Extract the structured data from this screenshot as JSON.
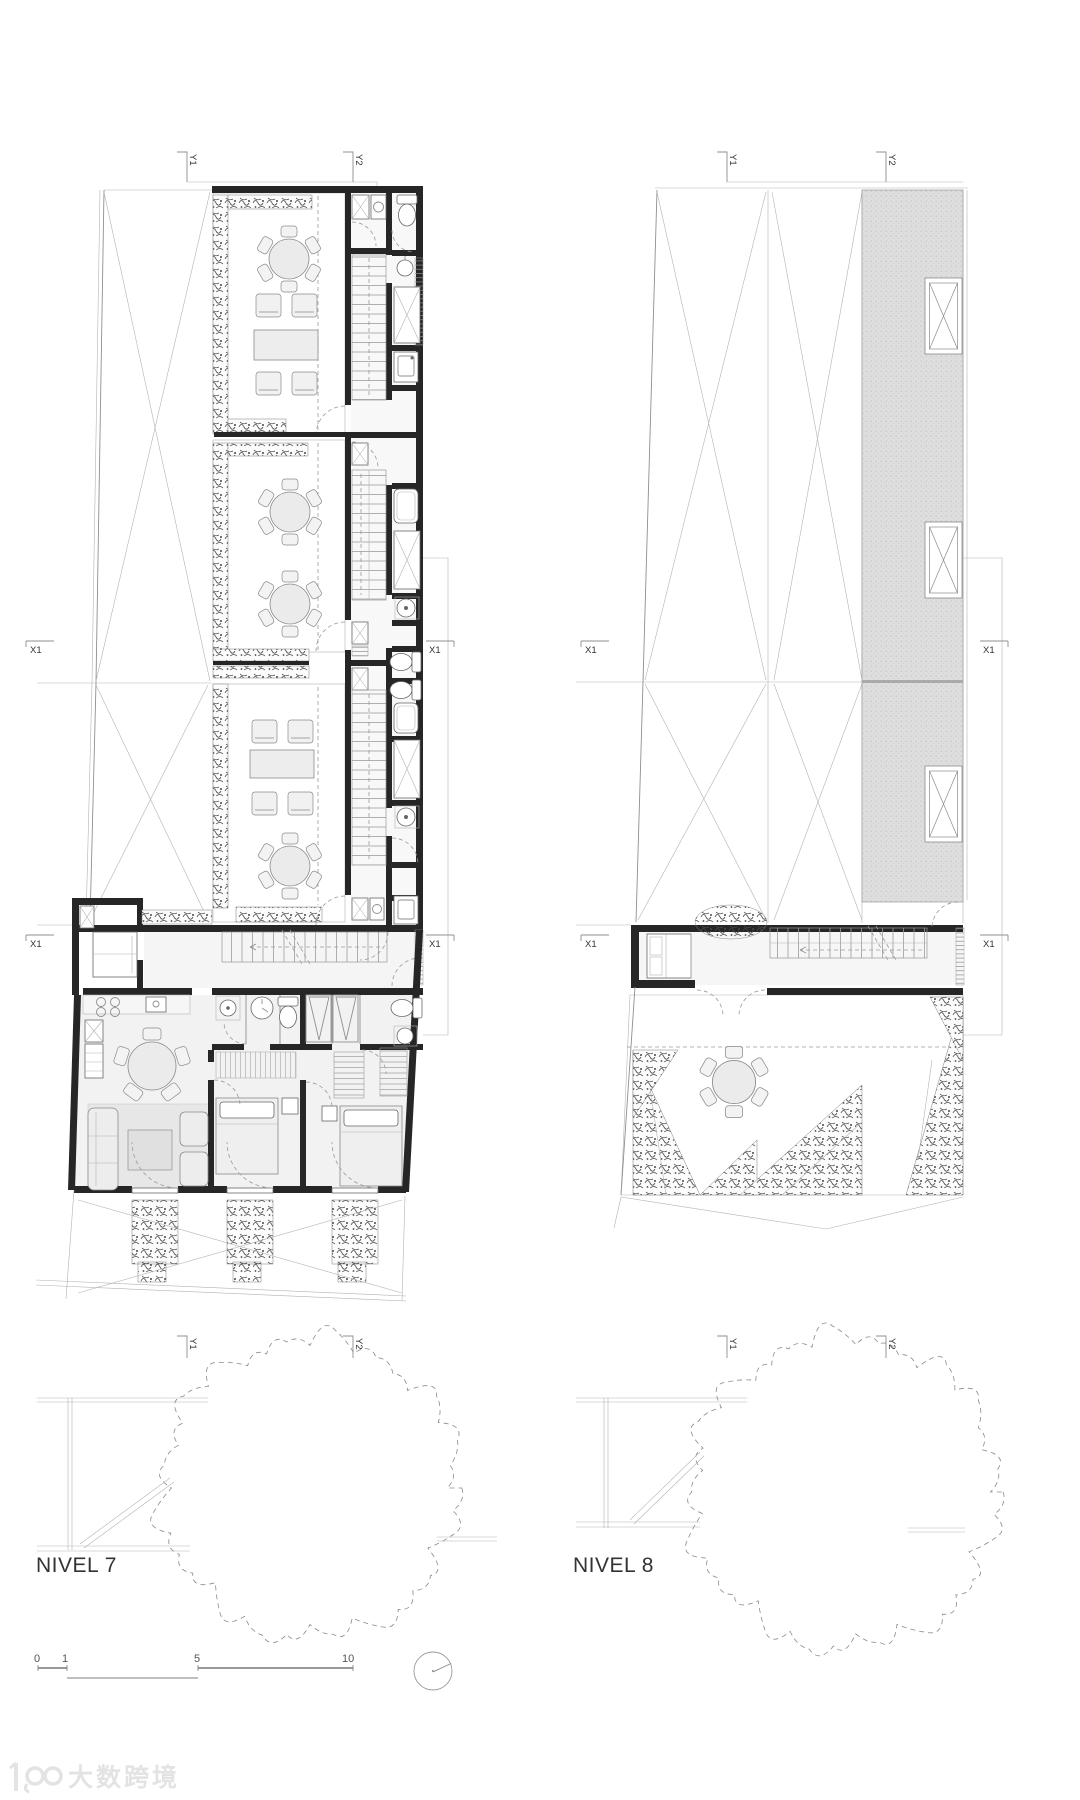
{
  "sheet": {
    "plans": [
      {
        "label": "NIVEL 7"
      },
      {
        "label": "NIVEL 8"
      }
    ],
    "markers": {
      "y1": "Y1",
      "y2": "Y2",
      "x1": "X1"
    },
    "scale_bar": {
      "labels": [
        "0",
        "1",
        "5",
        "10"
      ]
    },
    "icons": {
      "north_arrow": "compass-circle"
    },
    "watermark": {
      "text": "大数跨境"
    },
    "colors": {
      "paper": "#ffffff",
      "wall": "#262626",
      "thin_line": "#8f8f8f",
      "deck_line": "#c9c9c9",
      "roof_gray": "#dedede",
      "vegetation": "#474747",
      "floor": "#f2f2f2",
      "watermark": "#e3e3e3"
    }
  }
}
